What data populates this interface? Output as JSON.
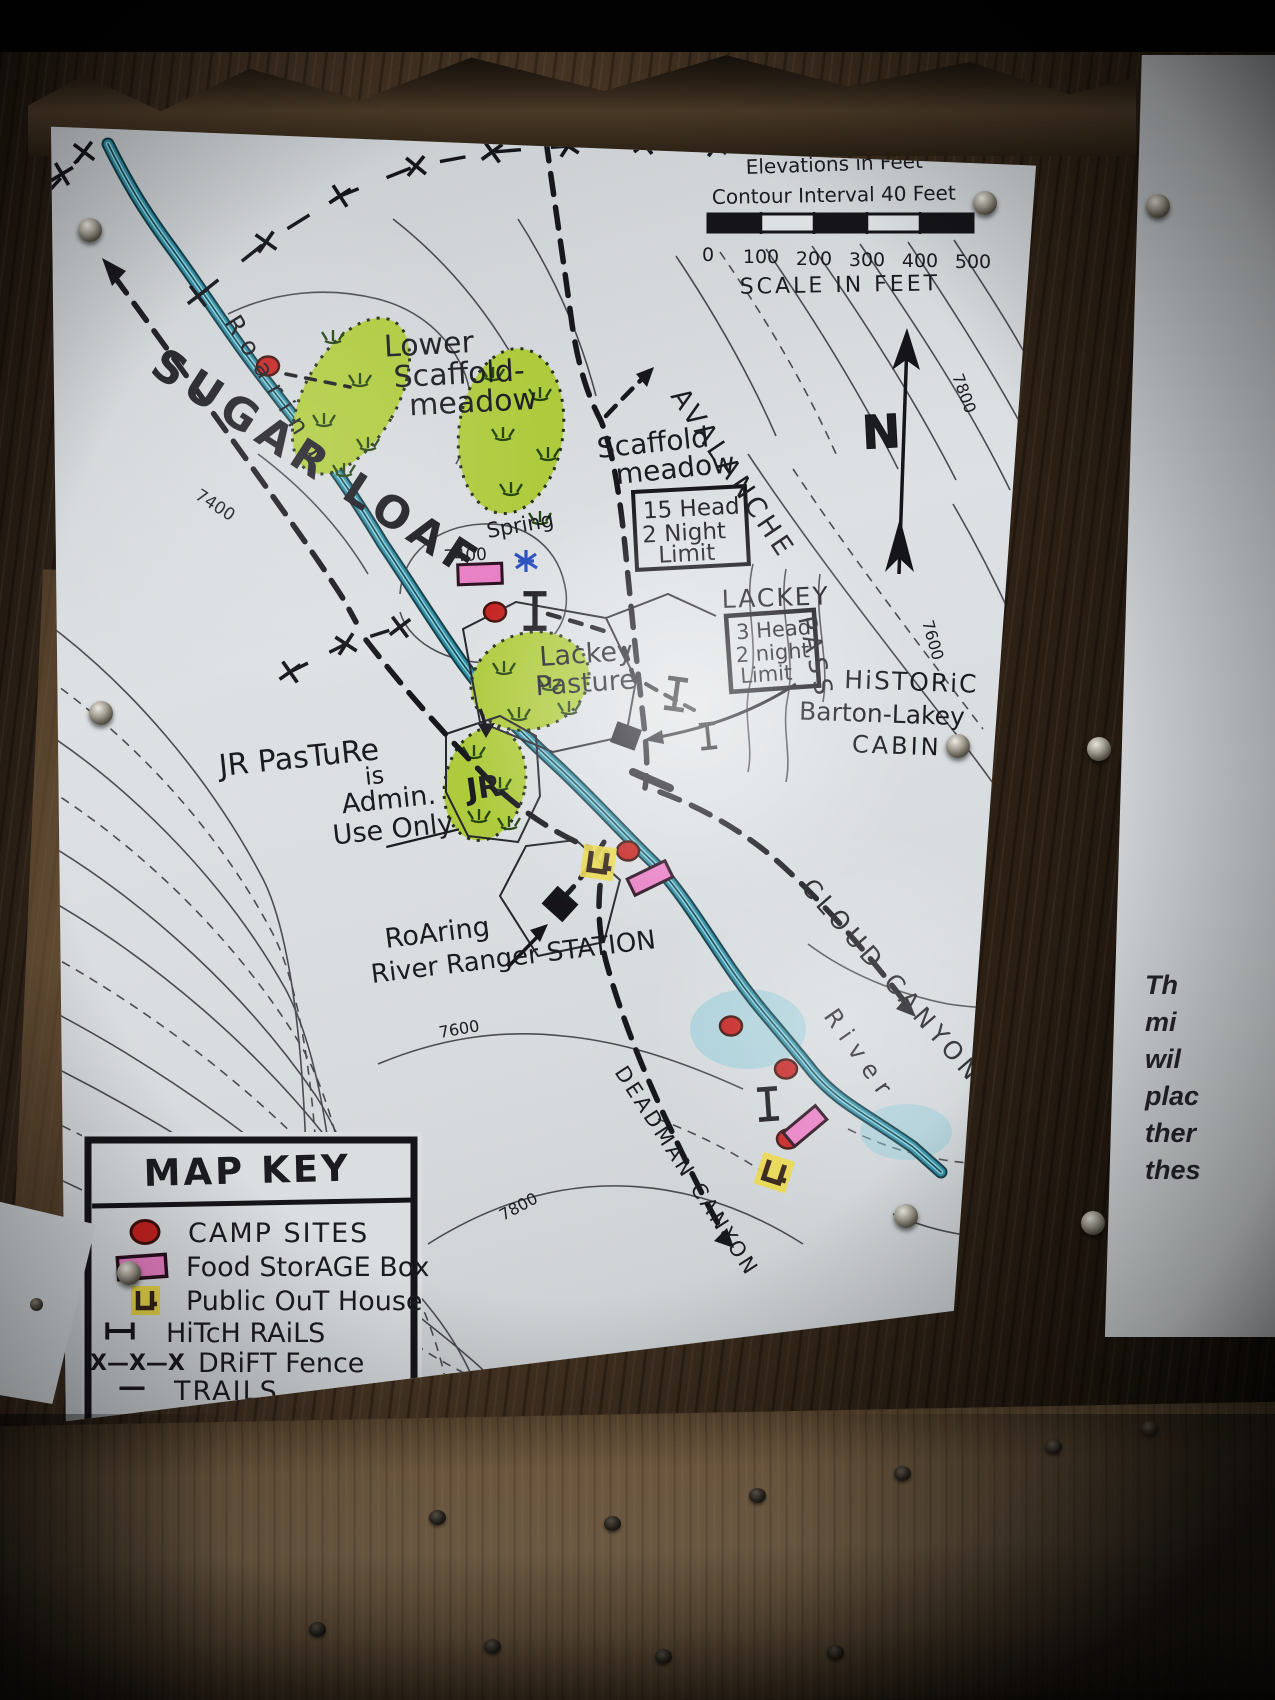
{
  "map": {
    "notes": {
      "elevations": "Elevations in Feet",
      "contour_interval": "Contour Interval 40 Feet"
    },
    "scale": {
      "ticks": [
        "0",
        "100",
        "200",
        "300",
        "400",
        "500"
      ],
      "caption": "SCALE IN FEET"
    },
    "compass": {
      "north": "N"
    },
    "features": {
      "sugarloaf": "SUGAR LOAF",
      "roaring": "Roaring",
      "river": "River",
      "lower_scaffold_meadow": [
        "Lower",
        "Scaffold-",
        "meadow"
      ],
      "scaffold_meadow": [
        "Scaffold",
        "meadow"
      ],
      "scaffold_limit": [
        "15 Head",
        "2 Night",
        "Limit"
      ],
      "lackey": "LACKEY",
      "lackey_limit": [
        "3 Head",
        "2 night",
        "Limit"
      ],
      "avalanche": "AVALANCHE",
      "pass": "PASS",
      "historic_cabin": [
        "HiSTORiC",
        "Barton-Lakey",
        "CABIN"
      ],
      "lackey_pasture": [
        "Lackey",
        "Pasture"
      ],
      "jr_pasture": [
        "JR PasTuRe",
        "is",
        "Admin.",
        "Use Only"
      ],
      "jr": "JR",
      "spring": "Spring",
      "ranger_station": [
        "RoAring",
        "River Ranger STATION"
      ],
      "cloud_canyon": "CLOUD CANYON",
      "deadman_canyon": "DEADMAN CANYON"
    },
    "contour_labels": {
      "left_7400": "7400",
      "spring_7400": "7400",
      "right_7800": "7800",
      "right_7600": "7600",
      "lower_7600": "7600",
      "lower_7800": "7800"
    },
    "legend": {
      "title": "MAP KEY",
      "items": [
        {
          "symbol": "campsite-dot",
          "label": "CAMP SITES"
        },
        {
          "symbol": "food-storage-box",
          "label": "Food StorAGE Box"
        },
        {
          "symbol": "outhouse",
          "label": "Public OuT House"
        },
        {
          "symbol": "hitch-rail",
          "label": "HiTcH RAiLS"
        },
        {
          "symbol": "drift-fence",
          "glyph": "X—X—X",
          "label": "DRiFT Fence"
        },
        {
          "symbol": "trail",
          "glyph": "—",
          "label": "TRAILS"
        }
      ]
    },
    "colors": {
      "ink": "#1b1b22",
      "paper": "#dadee1",
      "river": "#2f8da3",
      "meadow": "#aecb3d",
      "campsite": "#c42220",
      "food_box": "#e87fc4",
      "outhouse": "#e9d84a"
    }
  },
  "adjacent_sign": {
    "fragments": [
      "Th",
      "mi",
      "wil",
      "plac",
      "ther",
      "thes"
    ]
  }
}
